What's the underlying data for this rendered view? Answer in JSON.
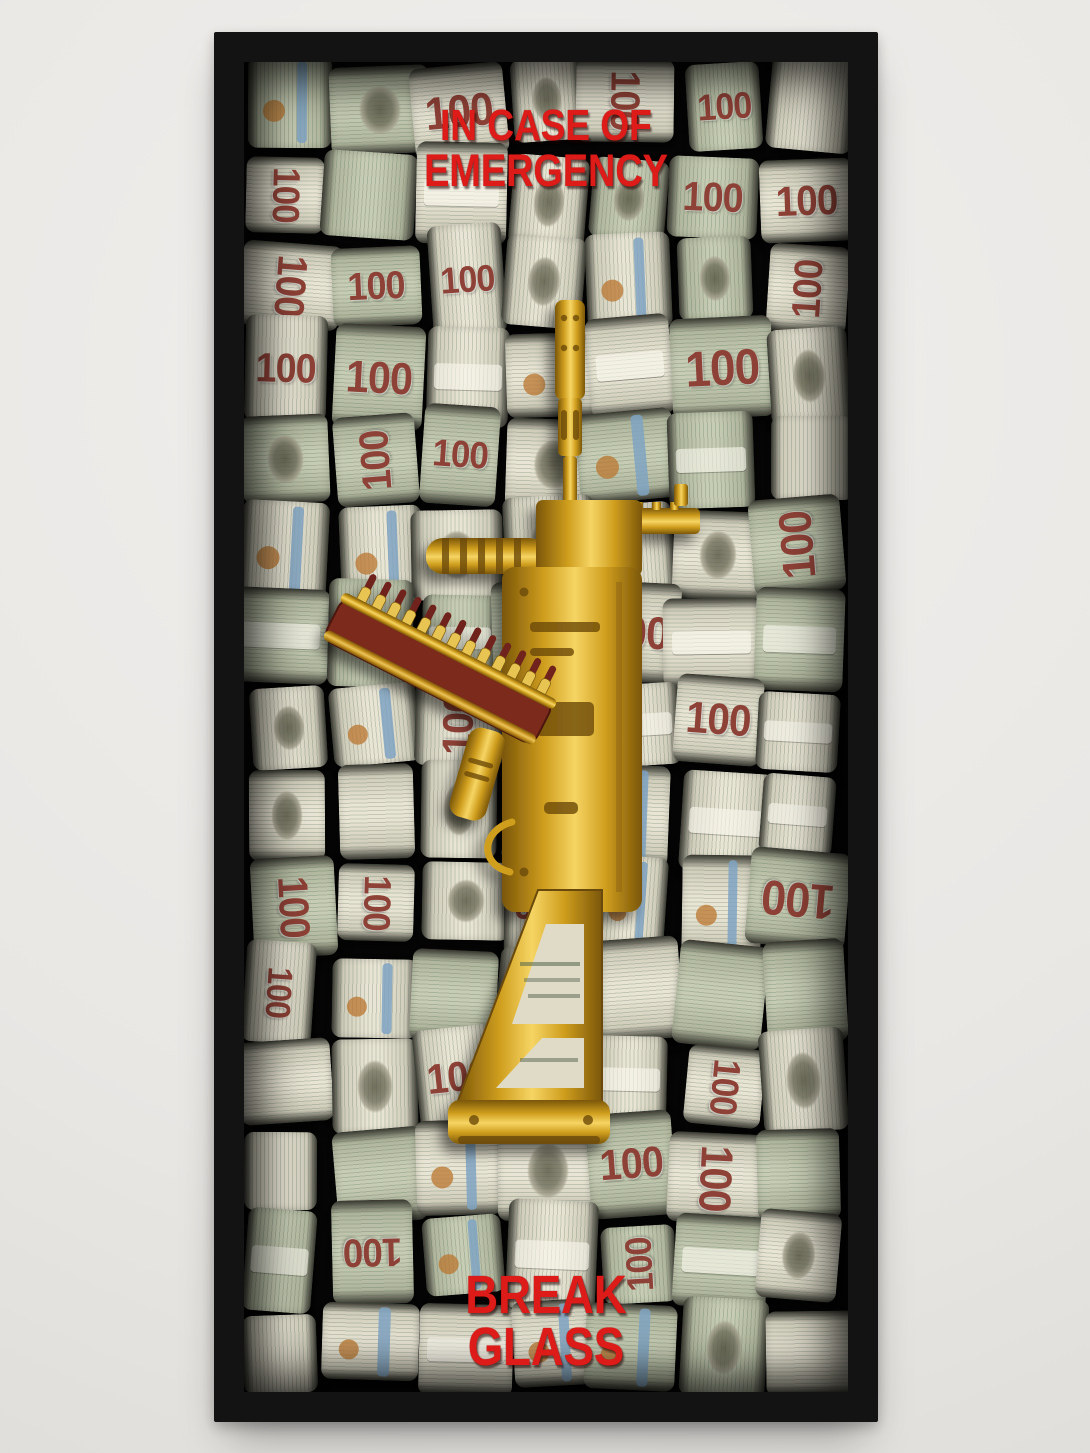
{
  "wall": {
    "color": "#e9e7e4"
  },
  "frame": {
    "color": "#131313"
  },
  "captions": {
    "color": "#dd1c19",
    "top": {
      "line1": "IN CASE OF",
      "line2": "EMERGENCY"
    },
    "bottom": {
      "line1": "BREAK",
      "line2": "GLASS"
    }
  },
  "bill": {
    "denomination": "100"
  },
  "collage": {
    "seed": 42,
    "rows": 15,
    "cols": 7,
    "background": "#060606",
    "palette": {
      "paper_light": "#e9e5d4",
      "paper_mid": "#cfccba",
      "paper_green": "#c7cdb4",
      "paper_green_mid": "#b0b69d",
      "ink_green": "#3f5a49",
      "numeral_red": "#8e4136",
      "stripe_blue": "#7fa3c2",
      "seal_copper": "#b9762f",
      "edge_dark": "#3c3b33"
    }
  },
  "rifle": {
    "gold_dark": "#7a5609",
    "gold_main": "#cf9e1e",
    "gold_light": "#f6d564",
    "magazine_red": "#7c2a1e",
    "bullet_case": "#e8c452",
    "bullet_tip": "#6f241a",
    "cutout_paper": "#e0dbc6"
  }
}
